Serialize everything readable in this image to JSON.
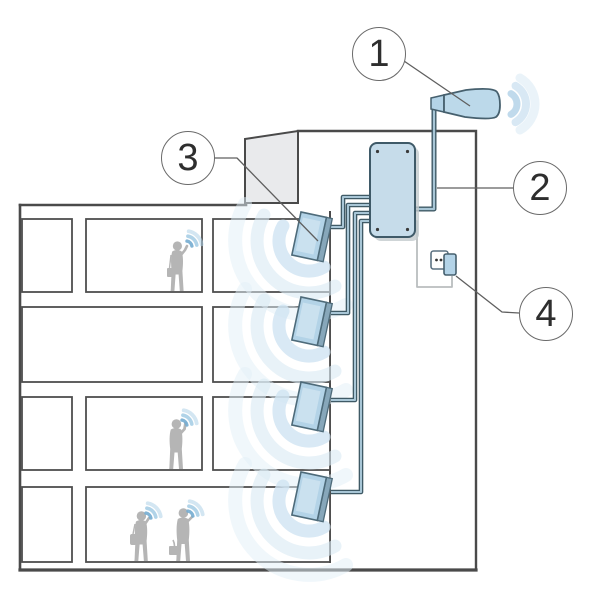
{
  "diagram": {
    "description": "Cutaway illustration of a four-storey building with an in-building cellular signal repeater system",
    "callouts": [
      {
        "label": "1",
        "points_to": "outdoor-antenna"
      },
      {
        "label": "2",
        "points_to": "antenna-cable"
      },
      {
        "label": "3",
        "points_to": "indoor-antenna"
      },
      {
        "label": "4",
        "points_to": "power-outlet"
      }
    ],
    "icons": [
      "outdoor-antenna",
      "signal-booster",
      "indoor-antenna",
      "power-outlet",
      "power-plug",
      "signal-waves",
      "person-silhouette",
      "rooftop-structure"
    ],
    "colors": {
      "line_work": "#4a4a4a",
      "device_fill": "#bcd9ea",
      "device_stroke": "#46606e",
      "cable_dark": "#3f5a66",
      "cable_core": "#a8c6d6",
      "roof_structure_gray": "#e9eaec",
      "silhouette_gray": "#b5b5b5",
      "signal_blue": "#7fb5d8",
      "signal_soft_blue": "#d8e9f4",
      "callout_stroke": "#6a6a6a",
      "callout_text": "#2e2e2e"
    }
  }
}
